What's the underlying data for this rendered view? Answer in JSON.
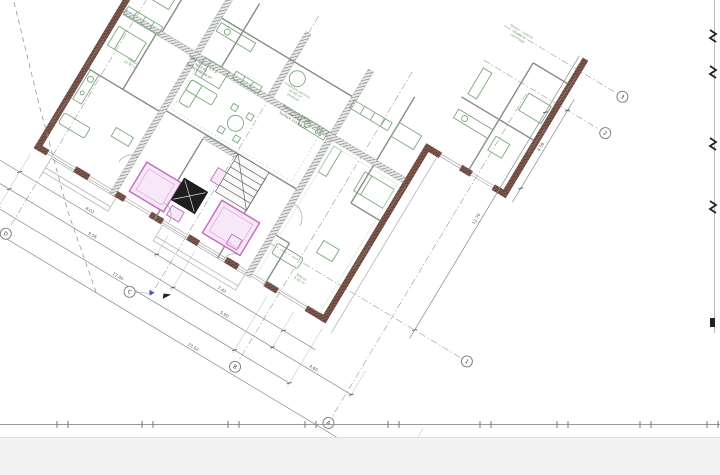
{
  "plan": {
    "grid": {
      "A": "A",
      "B": "B",
      "C": "C",
      "D": "D",
      "n1": "1",
      "n2": "2",
      "n3": "3"
    },
    "dims": {
      "d1": "8.02",
      "d2": "7.42",
      "d3": "9.56",
      "d4": "5.80",
      "d5": "4.60",
      "d6": "13.80",
      "d7": "23.92",
      "d8": "12.70",
      "d9": "4.56"
    },
    "labels": {
      "apt_left": {
        "l1": "Appartement 3.5 p.",
        "l2": "lot 2.01",
        "l3": "Surface 88.50 m²"
      },
      "mid_green": {
        "l1": "Chambre parents",
        "l2": "14.60 m²",
        "l3": "parquet"
      },
      "apt_mid": {
        "l1": "Appartement 4.5 p.",
        "l2": "lot 2.02",
        "l3": "Surface 112.60 m²"
      },
      "right_green": {
        "l1": "Séjour - cuisine",
        "l2": "35.20 m²",
        "l3": "carrelage"
      },
      "balcon": {
        "l1": "Balcon",
        "l2": "9.60 m²"
      },
      "left_green": {
        "l1": "Séjour",
        "l2": "24.80 m²"
      }
    },
    "colors": {
      "wall": "#83594d",
      "furniture": "#7aa87a",
      "highlight": "#c36ac3",
      "grid_line": "#8a8a8a",
      "footer_band": "#f2f2f2"
    }
  }
}
